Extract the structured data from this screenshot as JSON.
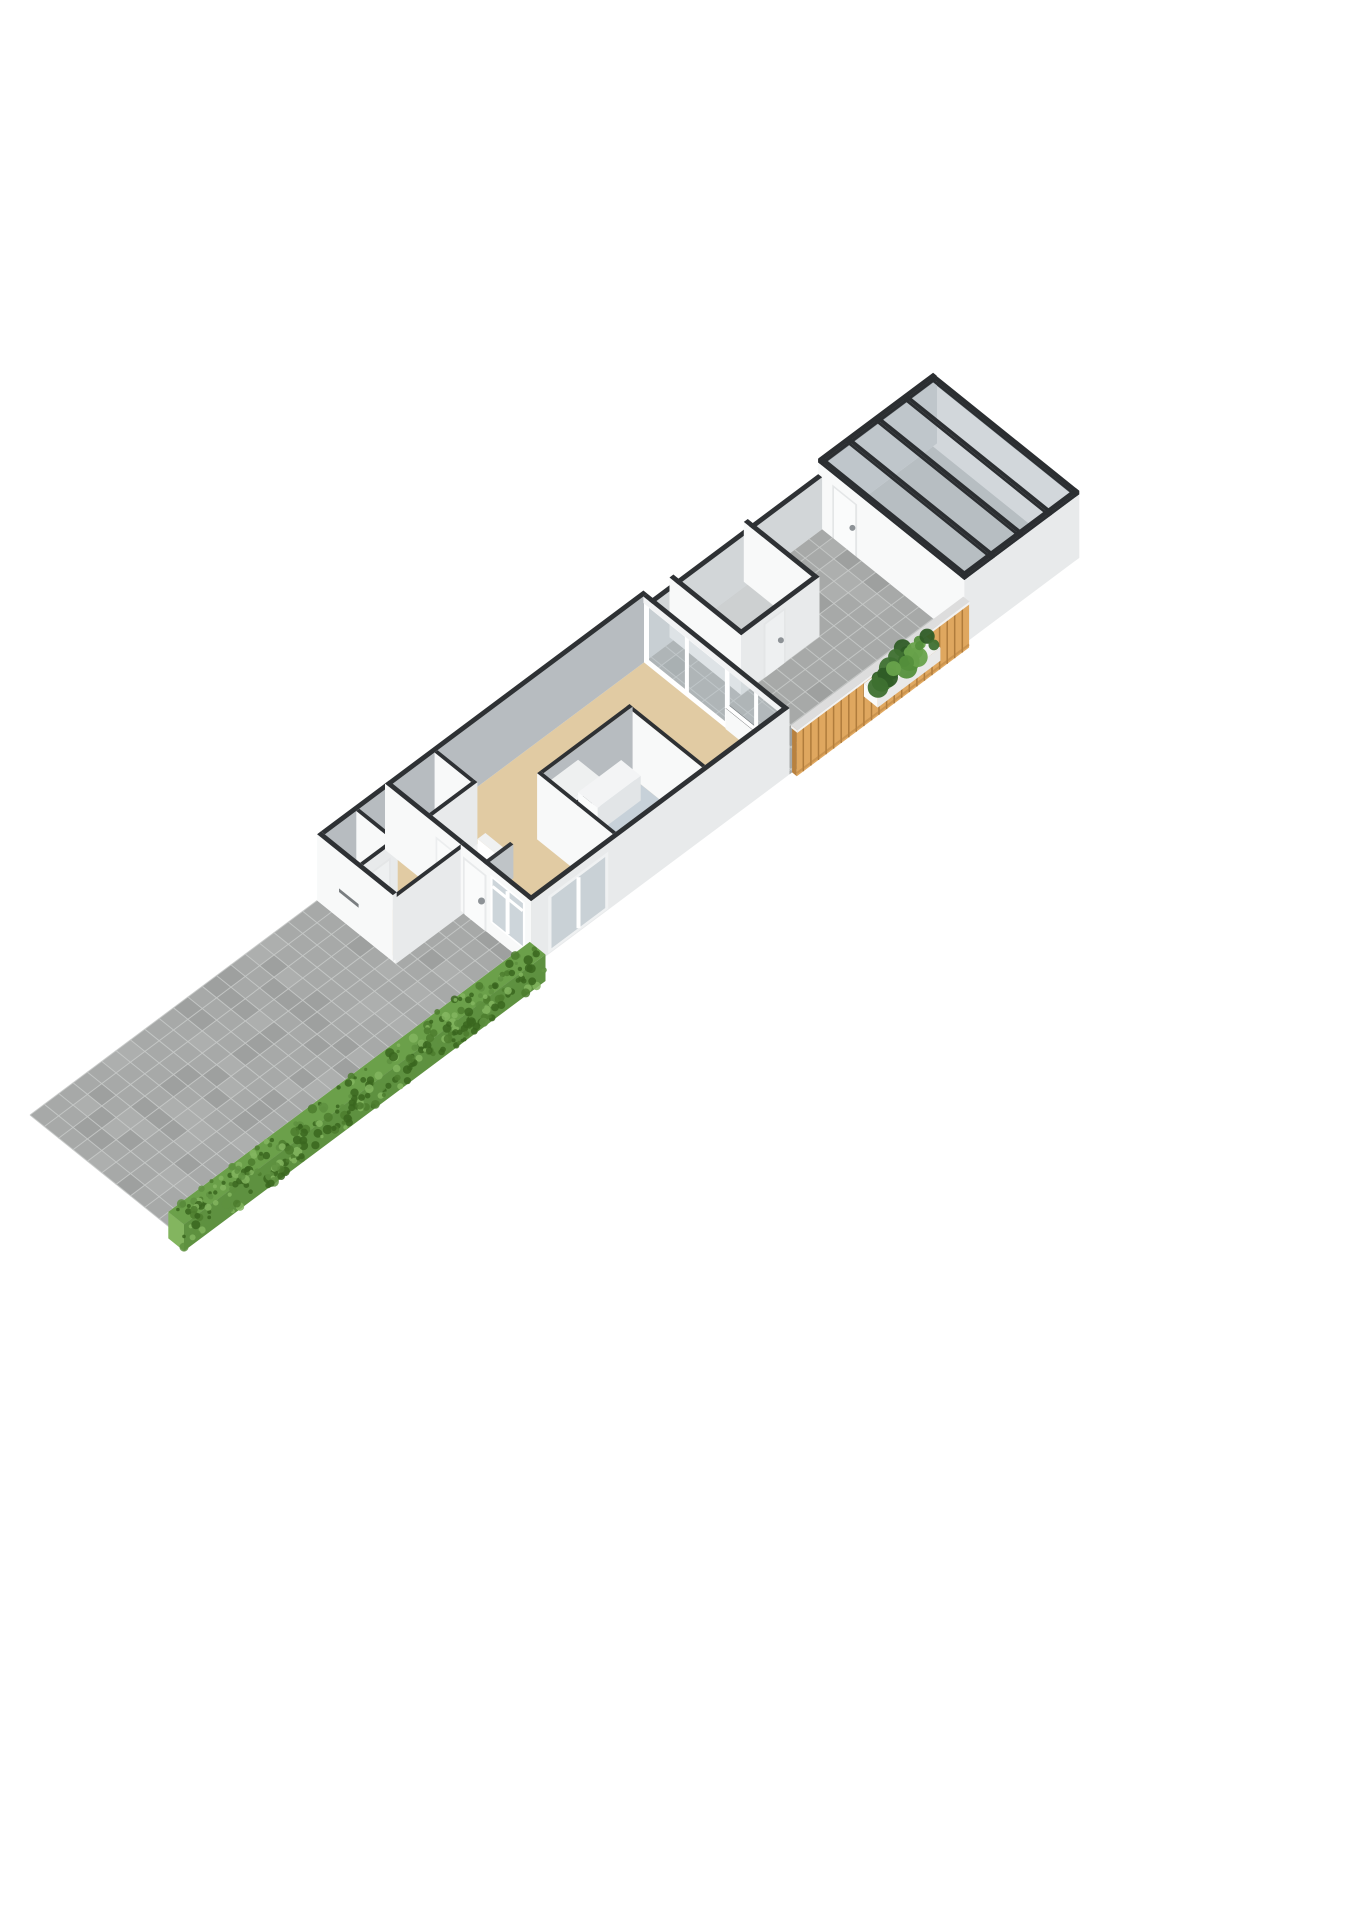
{
  "scene": {
    "type": "isometric-3d-floorplan-render",
    "background": "#ffffff",
    "areas": [
      {
        "name": "driveway",
        "surface": "concrete-pavers"
      },
      {
        "name": "front-porch",
        "surface": "concrete-pavers"
      },
      {
        "name": "hedge",
        "kind": "greenery-strip"
      },
      {
        "name": "entrance-hall",
        "surface": "beige-floor"
      },
      {
        "name": "toilet",
        "surface": "gray-floor"
      },
      {
        "name": "storage-closet",
        "surface": "gray-floor"
      },
      {
        "name": "staircase",
        "steps": 5
      },
      {
        "name": "living-room",
        "surface": "beige-floor"
      },
      {
        "name": "kitchen-nook",
        "surface": "blue-gray-floor",
        "units": [
          "tall-cabinet-with-appliances",
          "counter",
          "island-counter"
        ]
      },
      {
        "name": "terrace",
        "surface": "concrete-pavers"
      },
      {
        "name": "shed",
        "surface": "gray-floor",
        "door": "white-single"
      },
      {
        "name": "planter",
        "contents": "shrubs"
      },
      {
        "name": "wood-fence",
        "material": "vertical-planks"
      },
      {
        "name": "garage",
        "roof": "glazed-dark-framed-panels",
        "door": "white-single"
      }
    ],
    "openings": [
      {
        "name": "front-door",
        "wall": "street-facade"
      },
      {
        "name": "letterbox-slot",
        "wall": "street-facade"
      },
      {
        "name": "front-window",
        "wall": "street-facade",
        "panes": 2
      },
      {
        "name": "side-sliding-door",
        "wall": "side-facade"
      },
      {
        "name": "terrace-sliding-doors",
        "wall": "rear-facade",
        "panes": 2
      },
      {
        "name": "terrace-fixed-glass-over-low-wall",
        "wall": "rear-facade"
      },
      {
        "name": "hall-door",
        "wall": "interior"
      },
      {
        "name": "toilet-door",
        "wall": "interior"
      }
    ]
  },
  "palette": {
    "bg": "#ffffff",
    "cap": "#2e3134",
    "capSoft": "#35383b",
    "wallBright": "#f8f9f9",
    "wallLight": "#e8eaeb",
    "wallShade": "#b7bcc0",
    "wallShade2": "#d2d6d8",
    "floorLiving": "#e1cba3",
    "floorKitchen": "#c7d1d9",
    "floorGray": "#cdd0d1",
    "floorGarage": "#c3c6c7",
    "paver": "#a7a9a8",
    "paverLine": "#c7c9c8",
    "hedgeBase": "#5e9140",
    "hedgeDark": "#3a661f",
    "hedgeLight": "#83b55f",
    "hedgeTop": "#6ba04a",
    "wood": "#dfa75f",
    "woodDark": "#b8813f",
    "woodLine": "#97662a",
    "railWhite": "#f2f2f2",
    "railTop": "#dddddd",
    "glass": "rgba(186,197,205,0.42)",
    "glassSolid": "#cdd5da",
    "roofGlass": "rgba(172,181,190,0.50)",
    "roofBeam": "#2b2e31",
    "frame": "#ffffff",
    "frameShade": "#e4e6e7",
    "doorLeaf": "#fafbfb",
    "doorLeafShade": "#eef0f1",
    "handle": "#8d9296",
    "appliance": "#3a3d41",
    "stepTop": "#f0f1f1",
    "stepFace": "#ffffff",
    "stepSide": "#d5d8da",
    "plant1": "#3e7030",
    "plant2": "#55903c",
    "plant3": "#2f5c26",
    "plant4": "#68a24b",
    "slot": "#7a7e81"
  }
}
